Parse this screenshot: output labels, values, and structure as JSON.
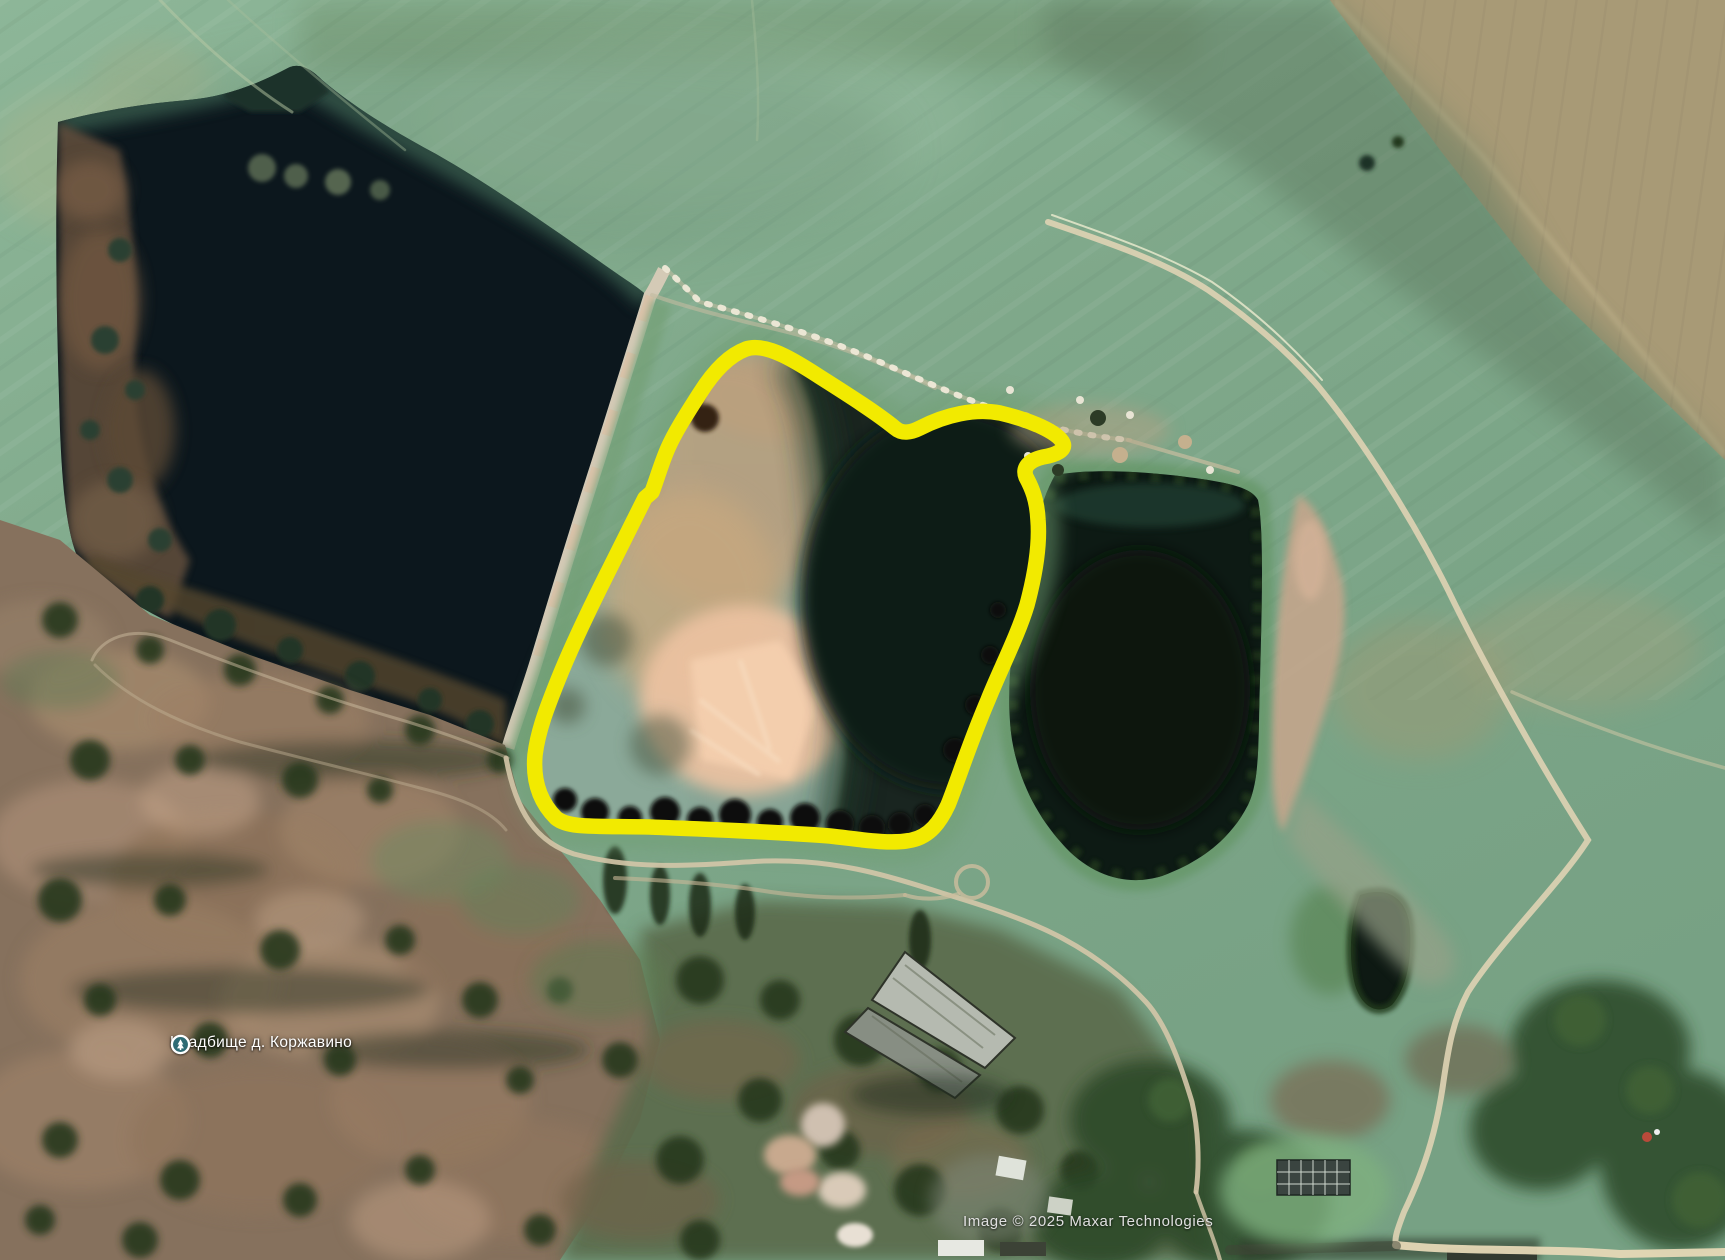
{
  "map": {
    "type": "satellite-imagery",
    "place_label": {
      "text": "Кладбище д. Коржавино",
      "icon": "cemetery-marker-icon"
    },
    "attribution": {
      "text": "Image © 2025 Maxar Technologies"
    },
    "annotation": {
      "shape": "hand-drawn-loop",
      "purpose": "highlighted-settling-pond",
      "stroke_color": "#f2ea00"
    },
    "colors": {
      "annotation_yellow": "#f2ea00",
      "field_green": "#82aa8d",
      "harvested_field_tan": "#a89a76",
      "lake_water_dark": "#0c171d",
      "pond_shallow_teal": "#87a495",
      "pond_sediment_tan": "#c3a47f",
      "pond_sediment_pink": "#eec3a2",
      "pond_deep_green": "#13241c",
      "second_pond_dark": "#0d1a14",
      "scrub_brown": "#86715d",
      "road_tan": "#d6c9ac",
      "dam_gray": "#d4cab6",
      "label_text": "#ffffff",
      "attribution_text": "#e0e0e0",
      "marker_fill": "#2e6b74"
    }
  }
}
